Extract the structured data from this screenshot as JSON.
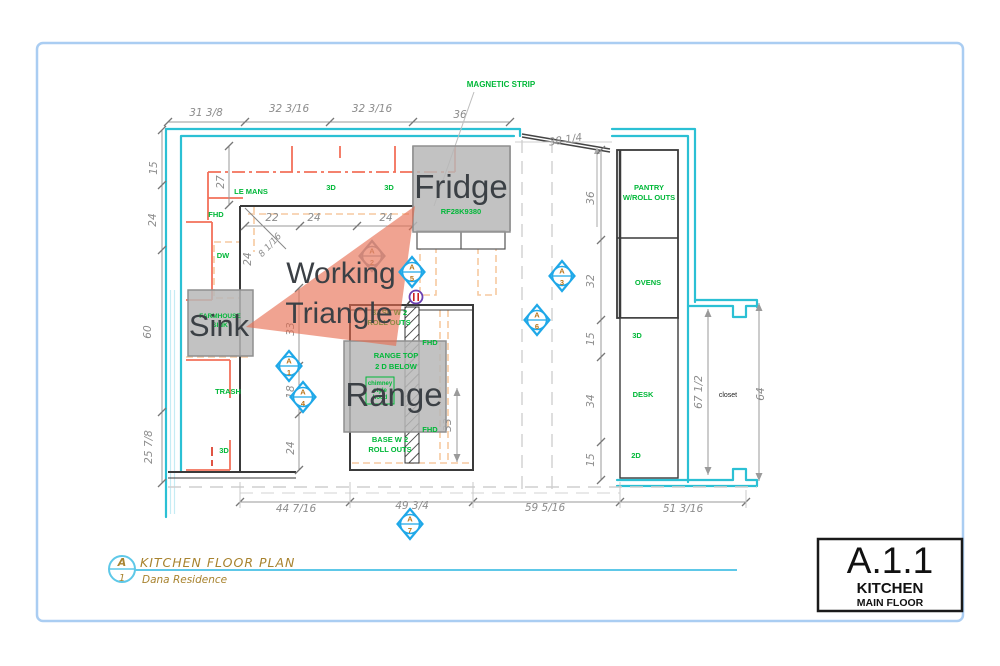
{
  "colors": {
    "wall_cyan": "#2bc0d4",
    "cabinet_coral": "#f3705a",
    "upper_cabinet_peach": "#f6c9a0",
    "label_green": "#00b838",
    "annotation_gray": "#3b4045",
    "triangle_salmon": "#e66a4d",
    "marker_blue": "#1fa8e8",
    "marker_gold": "#b8741a",
    "title_gold": "#a8832f",
    "page_frame": "#aacdf2"
  },
  "title_block": {
    "code": "A.1.1",
    "room": "KITCHEN",
    "floor": "MAIN FLOOR"
  },
  "drawing_title": {
    "name": "KITCHEN FLOOR PLAN",
    "residence": "Dana Residence",
    "callout_letter": "A",
    "callout_number": "1"
  },
  "overlay_labels": {
    "fridge": "Fridge",
    "sink": "Sink",
    "range": "Range",
    "working_line1": "Working",
    "working_line2": "Triangle"
  },
  "plan_labels": {
    "magnetic_strip": "MAGNETIC STRIP",
    "le_mans": "LE MANS",
    "top_3d_a": "3D",
    "top_3d_b": "3D",
    "fhd_left": "FHD",
    "dw": "DW",
    "farmhouse_line1": "FARMHOUSE",
    "farmhouse_line2": "SINK",
    "trash": "TRASH",
    "left_3d": "3D",
    "fridge_model": "RF28K9380",
    "base_top_line1": "BASE W 2",
    "base_top_line2": "ROLL OUTS",
    "fhd_island_top": "FHD",
    "fhd_island_bottom": "FHD",
    "range_top_line1": "RANGE TOP",
    "range_top_line2": "2 D BELOW",
    "hood_line1": "chimney",
    "hood_line2": "style",
    "hood_line3": "hood",
    "base_bottom_line1": "BASE W 2",
    "base_bottom_line2": "ROLL OUTS",
    "pantry_line1": "PANTRY",
    "pantry_line2": "W/ROLL OUTS",
    "ovens": "OVENS",
    "right_3d": "3D",
    "desk": "DESK",
    "right_2d": "2D",
    "closet": "closet"
  },
  "dimensions": {
    "top": [
      "31 3/8",
      "32 3/16",
      "32 3/16",
      "36"
    ],
    "door": "38 1/4",
    "left": [
      "15",
      "24",
      "60",
      "25 7/8"
    ],
    "top_inner": [
      "27",
      "22",
      "24",
      "24"
    ],
    "corner": [
      "24",
      "8 1/16"
    ],
    "left_inner": [
      "33",
      "18",
      "24"
    ],
    "island_depth": "33",
    "right": [
      "36",
      "32",
      "15",
      "34",
      "15"
    ],
    "closet": [
      "67 1/2",
      "64"
    ],
    "bottom": [
      "44 7/16",
      "49 3/4",
      "59 5/16",
      "51 3/16"
    ]
  },
  "markers": [
    {
      "letter": "A",
      "number": "1"
    },
    {
      "letter": "A",
      "number": "2"
    },
    {
      "letter": "A",
      "number": "3"
    },
    {
      "letter": "A",
      "number": "4"
    },
    {
      "letter": "A",
      "number": "5"
    },
    {
      "letter": "A",
      "number": "6"
    },
    {
      "letter": "A",
      "number": "7"
    }
  ]
}
